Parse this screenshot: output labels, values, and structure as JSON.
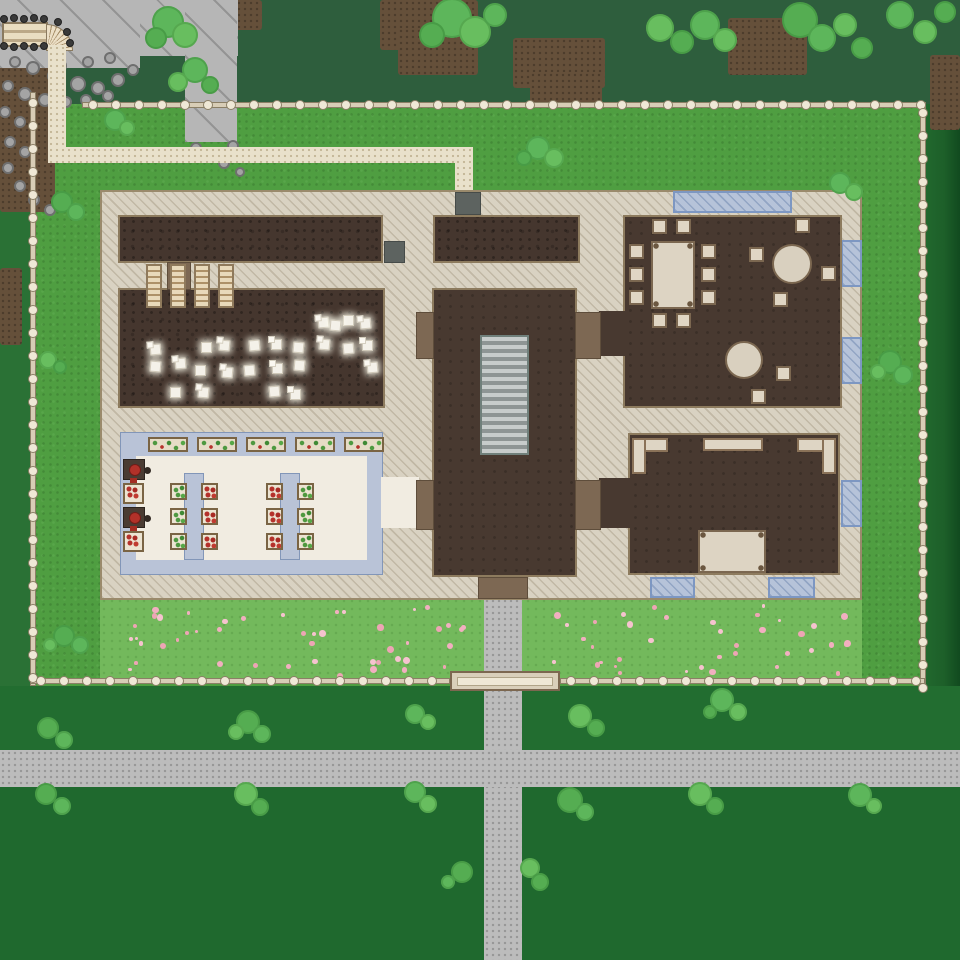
{
  "scene": {
    "kind": "game-map",
    "view": "top-down",
    "visible_text": "",
    "description": "Fenced compound with a large multi-room building, cliff with bridge and spiral stair at north-west, sand footpath, gravel road, flower meadow and trees"
  },
  "palette": {
    "grass_outside": "#226d30",
    "grass_top_band": "#2e5e3d",
    "grass_inside": "#4f9e41",
    "flower_meadow": "#73b95c",
    "flower_pink": "#f2afc0",
    "road_gray": "#bcbcbc",
    "footpath_sand": "#e9e1cb",
    "floor_hatch": "#d9d2c2",
    "wall_brown": "#8d7b5e",
    "soil_room": "#45362e",
    "window_blue": "#b6c3d9",
    "water_channel_blue": "#b9c3d7",
    "cream_floor": "#f1ece1",
    "door_brown": "#7d6853",
    "door_gray": "#5d6360",
    "cliff_gray": "#b6b6b6",
    "fence_beige": "#d8cdb6",
    "stairs_gray": "#9ca3a3",
    "crop_red": "#b5312b",
    "crop_green": "#4e9940",
    "tree_green": "#5db65b"
  },
  "map": {
    "perimeter_fence": {
      "sides": 4,
      "gates": 1,
      "gate_side": "south"
    },
    "cliff_area": {
      "bridge": 1,
      "spiral_stair": 1,
      "boulders": 31
    },
    "paths": {
      "sand_footpath_segments": 3,
      "gravel_road_horizontal": 1,
      "gravel_path_vertical": 1
    },
    "building": {
      "rooms": [
        {
          "name": "north-room-left",
          "floor": "dark soil",
          "contents": "4 drying racks across south wall, 1 gray door east"
        },
        {
          "name": "north-room-right",
          "floor": "dark soil",
          "contents": "gray exterior door on north wall"
        },
        {
          "name": "workshop-hall",
          "floor": "dark soil",
          "contents": "25 glowing white item piles"
        },
        {
          "name": "greenhouse",
          "floor": "cream tile with blue water channels",
          "contents": "5 trough planters, 12 crop planters, 2 wall planters, 2 red press machines"
        },
        {
          "name": "central-hall",
          "floor": "dark",
          "contents": "gray staircase, 4 brown side doors, 1 brown south entrance"
        },
        {
          "name": "dining-room",
          "floor": "dark",
          "contents": "1 long table with 10 stools, 2 round tables with 6 stools"
        },
        {
          "name": "kitchen",
          "floor": "dark",
          "contents": "5 counter segments, 1 prep table"
        }
      ],
      "windows": 6,
      "doors": {
        "gray": 2,
        "brown": 5
      }
    },
    "counts": {
      "tree_blobs": 64,
      "boulders": 31,
      "item_piles": 25,
      "pink_flowers": 85,
      "stools": 16,
      "fence_posts_spacing_px": 23
    }
  }
}
